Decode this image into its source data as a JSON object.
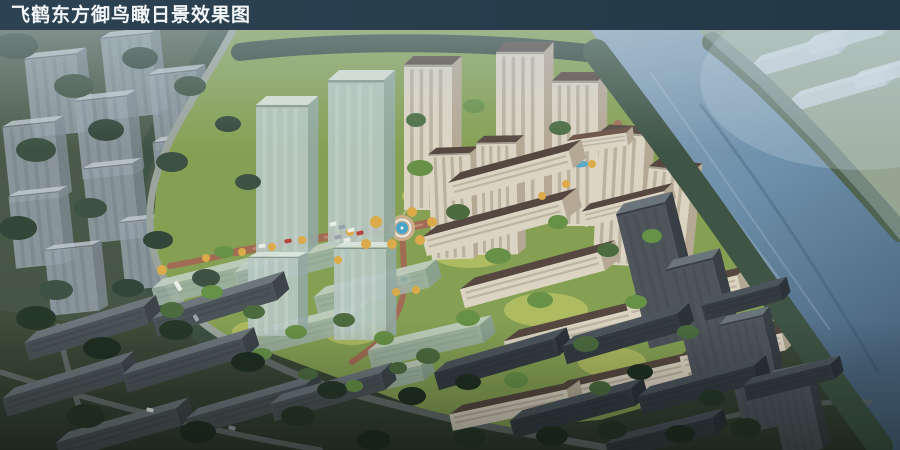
{
  "header": {
    "title": "飞鹤东方御鸟瞰日景效果图"
  },
  "scene": {
    "type": "architectural-aerial-daytime-rendering",
    "regions": {
      "river": "river",
      "far_bank": "far-riverbank-with-massing-blocks",
      "context_northwest": "translucent-gray-context-towers",
      "development_core": "residential-development-with-cream-towers-and-slab-rows",
      "glass_towers": "translucent-glass-future-phase-towers",
      "central_plaza": "circular-plaza-with-blue-fountain",
      "riverside_towers": "dark-highrise-towers-along-river",
      "context_south": "dark-existing-slab-blocks",
      "roads": "perimeter-and-internal-roads-with-cars"
    }
  },
  "palette": {
    "titlebar-bg-1": "#2d4252",
    "titlebar-bg-2": "#223846",
    "titlebar-text": "#f3f7f9",
    "base-top": "#5b6952",
    "base-bottom": "#2f3b2e",
    "river-1": "#8fa9be",
    "river-2": "#6e90aa",
    "river-3": "#4a657e",
    "river-streak": "#dde9f0",
    "farbank": "#7e8e6b",
    "farbank-tree": "#4f6351",
    "massing": "#d4dbe3",
    "ghost-front": "#97a3ac",
    "ghost-side": "#7e8a93",
    "ghost-top": "#c2cbd2",
    "ctx-ground": "#49584a",
    "ctx-tree-a": "#33463a",
    "ctx-tree-b": "#3d5243",
    "bank-tree": "#3e5444",
    "core-lawn": "#85a053",
    "core-lawn-bright": "#bcc465",
    "tree-bright": "#679147",
    "tree-mid": "#4c6b3f",
    "tree-autumn": "#dbab49",
    "road-red": "#a26c54",
    "road-red-light": "#ba8a6c",
    "plaza-pave": "#c9ad8c",
    "fountain-blue": "#48a4c8",
    "fountain-rim": "#e9eeea",
    "cream-wall": "#dcd4c3",
    "cream-shade": "#b5a894",
    "cream-stripe": "#978d7c",
    "roof-dark": "#564840",
    "club-roof": "#6b5244",
    "glass-front": "#b6c8c2",
    "glass-side": "#93a9a2",
    "glass-top": "#dee8e3",
    "glass-stripe": "#cfdcd6",
    "greenghost-front": "#9fb3a6",
    "greenghost-side": "#8aa096",
    "greenghost-top": "#c4d2c6",
    "darktower-front": "#4e565c",
    "darktower-side": "#383f45",
    "darktower-top": "#6a747b",
    "darktower-stripe": "#434b51",
    "ctxw-front": "#4a5357",
    "ctxw-side": "#3d4549",
    "ctxw-top": "#6c767b",
    "ctxe-front": "#343c42",
    "ctxe-side": "#2b3238",
    "ctxe-top": "#4c555c",
    "bottom-tree-a": "#263827",
    "bottom-tree-b": "#1f2f22",
    "road-gray": "#9ba49c",
    "road-gray-dark": "#646d6b",
    "road-mark": "#cfd6d0",
    "car-white": "#e9ece9",
    "car-red": "#b5443c",
    "car-gray": "#98a2aa",
    "haze": "#c3d2da"
  }
}
